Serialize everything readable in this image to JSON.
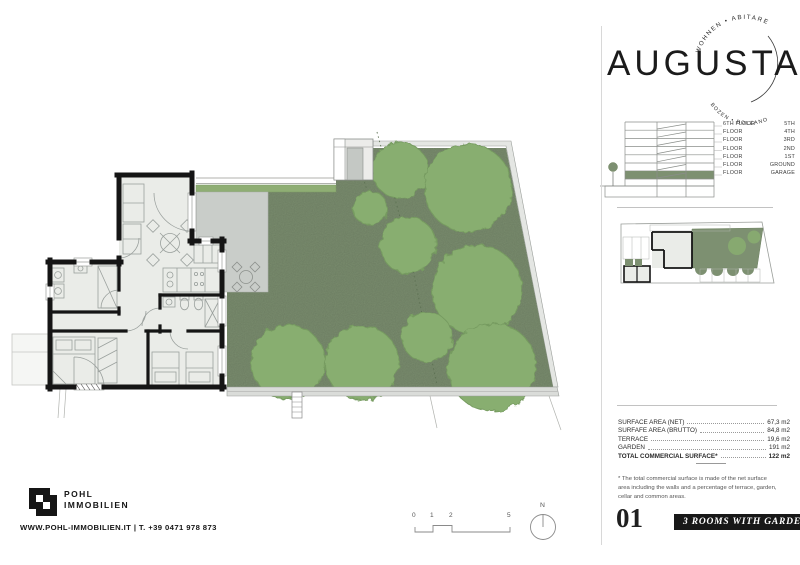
{
  "logo": {
    "wordmark": "AUGUSTA",
    "arc_top": "WOHNEN • ABITARE",
    "arc_bottom": "BOZEN • BOLZANO"
  },
  "floor_diagram": {
    "rows": [
      {
        "left": "6TH FLOOR",
        "right": "5TH"
      },
      {
        "left": "FLOOR",
        "right": "4TH"
      },
      {
        "left": "FLOOR",
        "right": "3RD"
      },
      {
        "left": "FLOOR",
        "right": "2ND"
      },
      {
        "left": "FLOOR",
        "right": "1ST"
      },
      {
        "left": "FLOOR",
        "right": "GROUND"
      },
      {
        "left": "FLOOR",
        "right": "GARAGE"
      }
    ]
  },
  "areas": {
    "rows": [
      {
        "label": "SURFACE AREA (NET)",
        "value": "67,3 m2"
      },
      {
        "label": "SURFAFE AREA (BRUTTO)",
        "value": "84,8 m2"
      },
      {
        "label": "TERRACE",
        "value": "19,6 m2"
      },
      {
        "label": "GARDEN",
        "value": "191 m2"
      }
    ],
    "total": {
      "label": "TOTAL COMMERCIAL SURFACE*",
      "value": "122 m2"
    },
    "footnote": "* The total commercial surface is made of the net surface area including the walls and a percentage of terrace, garden, cellar and common areas."
  },
  "unit": {
    "number": "01",
    "type_badge": "3 ROOMS WITH GARDEN"
  },
  "brand": {
    "name_line1": "POHL",
    "name_line2": "IMMOBILIEN",
    "contact": "WWW.POHL-IMMOBILIEN.IT | T. +39 0471 978 873"
  },
  "scale_bar": {
    "ticks": [
      "0",
      "1",
      "2",
      "5"
    ]
  },
  "north_label": "N",
  "colors": {
    "garden": "#7d9071",
    "tree": "#88ae70",
    "hedge": "#8fae74",
    "terrace": "#c9cdc9",
    "apartment_floor": "#eaece8",
    "wall": "#151515",
    "badge": "#181818"
  }
}
